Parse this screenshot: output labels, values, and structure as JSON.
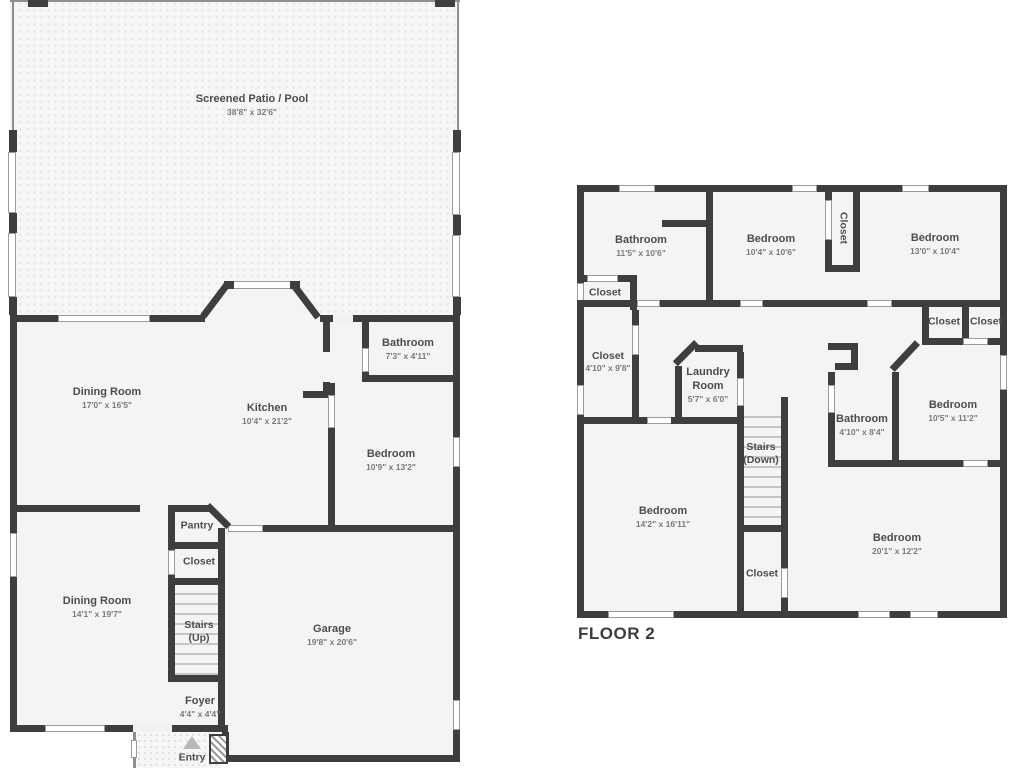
{
  "floor1": {
    "rooms": {
      "patio": {
        "name": "Screened Patio / Pool",
        "dims": "38'8\" x 32'6\""
      },
      "dining1": {
        "name": "Dining Room",
        "dims": "17'0\" x 16'5\""
      },
      "kitchen": {
        "name": "Kitchen",
        "dims": "10'4\" x 21'2\""
      },
      "bathroom": {
        "name": "Bathroom",
        "dims": "7'3\" x 4'11\""
      },
      "bedroom": {
        "name": "Bedroom",
        "dims": "10'9\" x 13'2\""
      },
      "pantry": {
        "name": "Pantry"
      },
      "closet": {
        "name": "Closet"
      },
      "stairs": {
        "name": "Stairs",
        "name2": "(Up)"
      },
      "dining2": {
        "name": "Dining Room",
        "dims": "14'1\" x 19'7\""
      },
      "garage": {
        "name": "Garage",
        "dims": "19'8\" x 20'6\""
      },
      "foyer": {
        "name": "Foyer",
        "dims": "4'4\" x 4'4\""
      },
      "entry": {
        "name": "Entry"
      }
    }
  },
  "floor2": {
    "label": "FLOOR 2",
    "rooms": {
      "bathroom1": {
        "name": "Bathroom",
        "dims": "11'5\" x 10'6\""
      },
      "bedroom1": {
        "name": "Bedroom",
        "dims": "10'4\" x 10'6\""
      },
      "closet_vert": {
        "name": "Closet"
      },
      "bedroom2": {
        "name": "Bedroom",
        "dims": "13'0\" x 10'4\""
      },
      "closet_small": {
        "name": "Closet"
      },
      "closet_410": {
        "name": "Closet",
        "dims": "4'10\" x 9'8\""
      },
      "laundry": {
        "name": "Laundry",
        "name2": "Room",
        "dims": "5'7\" x 6'0\""
      },
      "closet_r1": {
        "name": "Closet"
      },
      "closet_r2": {
        "name": "Closet"
      },
      "bathroom2": {
        "name": "Bathroom",
        "dims": "4'10\" x 8'4\""
      },
      "bedroom3": {
        "name": "Bedroom",
        "dims": "10'5\" x 11'2\""
      },
      "stairs": {
        "name": "Stairs",
        "name2": "(Down)"
      },
      "bedroom4": {
        "name": "Bedroom",
        "dims": "14'2\" x 16'11\""
      },
      "closet_bottom": {
        "name": "Closet"
      },
      "bedroom5": {
        "name": "Bedroom",
        "dims": "20'1\" x 12'2\""
      }
    }
  }
}
